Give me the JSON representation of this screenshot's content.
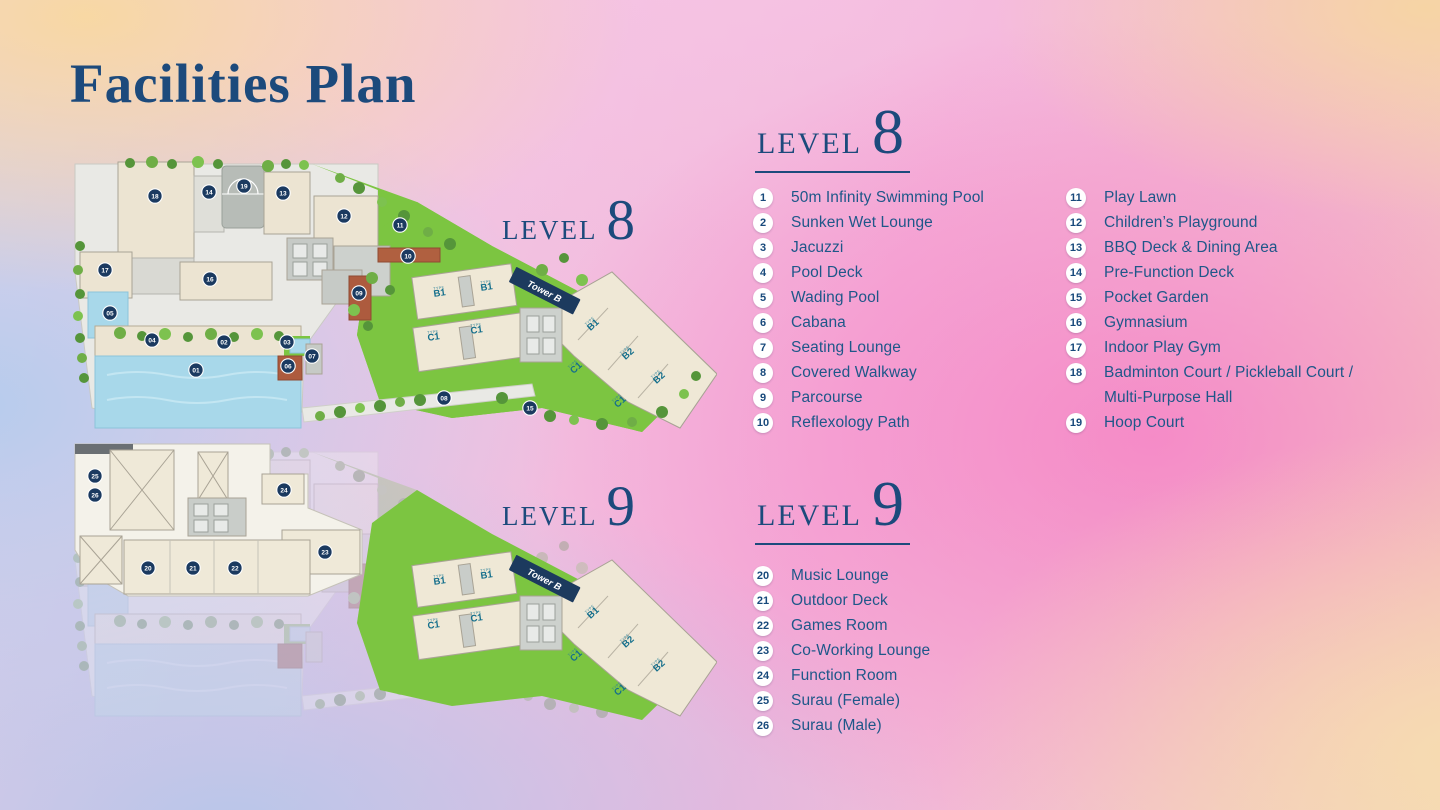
{
  "title": "Facilities Plan",
  "levels": [
    {
      "name": "LEVEL",
      "number": "8",
      "legend_columns": [
        [
          {
            "n": "1",
            "label": "50m Infinity Swimming Pool"
          },
          {
            "n": "2",
            "label": "Sunken Wet Lounge"
          },
          {
            "n": "3",
            "label": "Jacuzzi"
          },
          {
            "n": "4",
            "label": "Pool Deck"
          },
          {
            "n": "5",
            "label": "Wading Pool"
          },
          {
            "n": "6",
            "label": "Cabana"
          },
          {
            "n": "7",
            "label": "Seating Lounge"
          },
          {
            "n": "8",
            "label": "Covered Walkway"
          },
          {
            "n": "9",
            "label": "Parcourse"
          },
          {
            "n": "10",
            "label": "Reflexology Path"
          }
        ],
        [
          {
            "n": "11",
            "label": "Play Lawn"
          },
          {
            "n": "12",
            "label": "Children’s Playground"
          },
          {
            "n": "13",
            "label": "BBQ Deck & Dining Area"
          },
          {
            "n": "14",
            "label": "Pre-Function Deck"
          },
          {
            "n": "15",
            "label": "Pocket Garden"
          },
          {
            "n": "16",
            "label": "Gymnasium"
          },
          {
            "n": "17",
            "label": "Indoor Play Gym"
          },
          {
            "n": "18",
            "label": "Badminton Court / Pickleball Court /",
            "label2": "Multi-Purpose Hall"
          },
          {
            "n": "19",
            "label": "Hoop Court"
          }
        ]
      ]
    },
    {
      "name": "LEVEL",
      "number": "9",
      "legend_columns": [
        [
          {
            "n": "20",
            "label": "Music Lounge"
          },
          {
            "n": "21",
            "label": "Outdoor Deck"
          },
          {
            "n": "22",
            "label": "Games Room"
          },
          {
            "n": "23",
            "label": "Co-Working Lounge"
          },
          {
            "n": "24",
            "label": "Function Room"
          },
          {
            "n": "25",
            "label": "Surau (Female)"
          },
          {
            "n": "26",
            "label": "Surau (Male)"
          }
        ]
      ]
    }
  ],
  "plan": {
    "tower_label": "Tower B",
    "type_caption": "TYPE",
    "units": [
      {
        "code": "B1",
        "x": 368,
        "y": 146,
        "rot": -8
      },
      {
        "code": "B1",
        "x": 415,
        "y": 140,
        "rot": -8
      },
      {
        "code": "C1",
        "x": 362,
        "y": 190,
        "rot": -8
      },
      {
        "code": "C1",
        "x": 405,
        "y": 183,
        "rot": -8
      },
      {
        "code": "B1",
        "x": 523,
        "y": 177,
        "rot": -42
      },
      {
        "code": "B2",
        "x": 558,
        "y": 206,
        "rot": -42
      },
      {
        "code": "C1",
        "x": 506,
        "y": 220,
        "rot": -42
      },
      {
        "code": "B2",
        "x": 589,
        "y": 230,
        "rot": -42
      },
      {
        "code": "C1",
        "x": 550,
        "y": 254,
        "rot": -42
      }
    ],
    "l8_markers": [
      {
        "n": "01",
        "x": 124,
        "y": 220
      },
      {
        "n": "02",
        "x": 152,
        "y": 192
      },
      {
        "n": "03",
        "x": 215,
        "y": 192
      },
      {
        "n": "04",
        "x": 80,
        "y": 190
      },
      {
        "n": "05",
        "x": 38,
        "y": 163
      },
      {
        "n": "06",
        "x": 216,
        "y": 216
      },
      {
        "n": "07",
        "x": 240,
        "y": 206
      },
      {
        "n": "08",
        "x": 372,
        "y": 248
      },
      {
        "n": "09",
        "x": 287,
        "y": 143
      },
      {
        "n": "10",
        "x": 336,
        "y": 106
      },
      {
        "n": "11",
        "x": 328,
        "y": 75
      },
      {
        "n": "12",
        "x": 272,
        "y": 66
      },
      {
        "n": "13",
        "x": 211,
        "y": 43
      },
      {
        "n": "14",
        "x": 137,
        "y": 42
      },
      {
        "n": "15",
        "x": 458,
        "y": 258
      },
      {
        "n": "16",
        "x": 138,
        "y": 129
      },
      {
        "n": "17",
        "x": 33,
        "y": 120
      },
      {
        "n": "18",
        "x": 83,
        "y": 46
      },
      {
        "n": "19",
        "x": 172,
        "y": 36
      }
    ],
    "l9_markers": [
      {
        "n": "20",
        "x": 76,
        "y": 130
      },
      {
        "n": "21",
        "x": 121,
        "y": 130
      },
      {
        "n": "22",
        "x": 163,
        "y": 130
      },
      {
        "n": "23",
        "x": 253,
        "y": 114
      },
      {
        "n": "24",
        "x": 212,
        "y": 52
      },
      {
        "n": "25",
        "x": 23,
        "y": 38
      },
      {
        "n": "26",
        "x": 23,
        "y": 57
      }
    ]
  },
  "colors": {
    "heading_navy": "#1c4a7c",
    "list_blue": "#1e5789",
    "marker_navy": "#1b3a60",
    "banner_navy": "#1c3a5e",
    "unit_teal": "#156f8c",
    "lawn_green": "#7cc541",
    "pool_blue": "#a8d8ea",
    "building_beige": "#ece4d2"
  }
}
